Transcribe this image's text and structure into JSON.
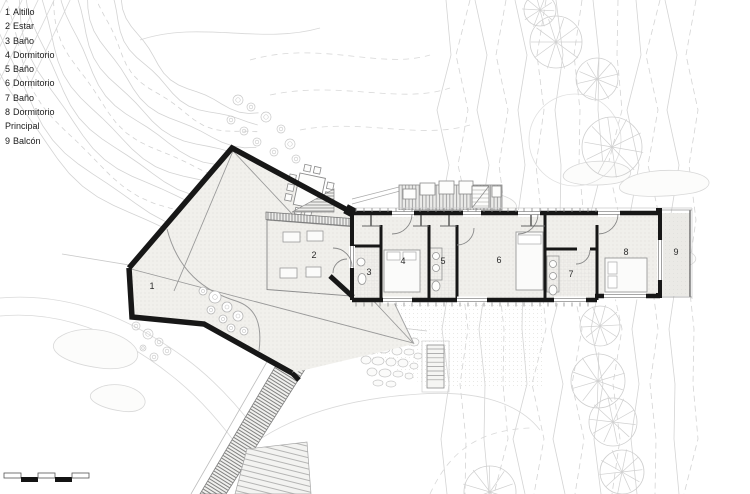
{
  "legend": {
    "items": [
      {
        "num": "1",
        "label": "Altillo"
      },
      {
        "num": "2",
        "label": "Estar"
      },
      {
        "num": "3",
        "label": "Baño"
      },
      {
        "num": "4",
        "label": "Dormitorio"
      },
      {
        "num": "5",
        "label": "Baño"
      },
      {
        "num": "6",
        "label": "Dormitorio"
      },
      {
        "num": "7",
        "label": "Baño"
      },
      {
        "num": "8",
        "label": "Dormitorio Principal"
      },
      {
        "num": "9",
        "label": "Balcón"
      }
    ]
  },
  "plan": {
    "room_labels": [
      "1",
      "2",
      "3",
      "4",
      "5",
      "6",
      "7",
      "8",
      "9"
    ]
  },
  "scale_bar": {
    "segments": 5
  },
  "colors": {
    "wall": "#171717",
    "floor": "#f1f0ec",
    "contour": "#d4d4d4",
    "hatch": "#6f6f6f",
    "text": "#1b1b1b"
  }
}
